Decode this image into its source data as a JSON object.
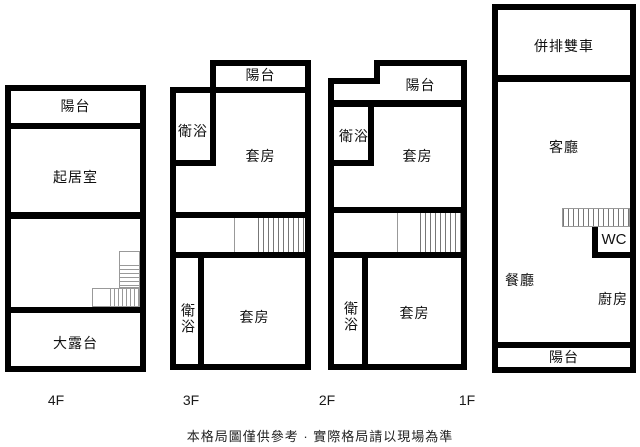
{
  "title": "樓層格局圖",
  "floors": [
    {
      "label": "4F",
      "rooms": {
        "balcony": "陽台",
        "living_room": "起居室",
        "terrace": "大露台"
      }
    },
    {
      "label": "3F",
      "rooms": {
        "balcony": "陽台",
        "bathroom_upper": "衛浴",
        "suite_upper": "套房",
        "bathroom_lower": "衛浴",
        "suite_lower": "套房"
      }
    },
    {
      "label": "2F",
      "rooms": {
        "balcony": "陽台",
        "bathroom_upper": "衛浴",
        "suite_upper": "套房",
        "bathroom_lower": "衛浴",
        "suite_lower": "套房"
      }
    },
    {
      "label": "1F",
      "rooms": {
        "garage": "併排雙車",
        "living_room": "客廳",
        "wc": "WC",
        "dining_room": "餐廳",
        "kitchen": "廚房",
        "balcony": "陽台"
      }
    }
  ],
  "footer": {
    "disclaimer": "本格局圖僅供參考 · 實際格局請以現場為準"
  },
  "colors": {
    "wall": "#000000",
    "stair_lines": "#777777",
    "text": "#111111",
    "background": "#ffffff"
  }
}
